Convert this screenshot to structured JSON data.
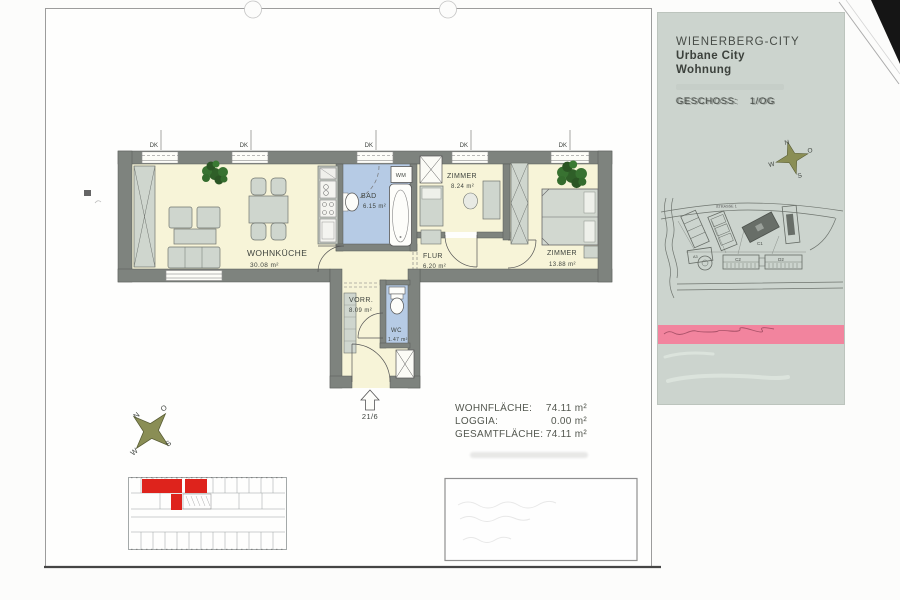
{
  "panel": {
    "title": "WIENERBERG-CITY",
    "subtitle_line1": "Urbane City",
    "subtitle_line2": "Wohnung",
    "floor_label": "GESCHOSS:",
    "floor_value": "1/OG",
    "site_plan": {
      "street_label": "STRASSE 1",
      "c1": "C1",
      "c2": "C2",
      "d2": "D2",
      "a3": "A3"
    },
    "compass": {
      "n": "N",
      "o": "O",
      "s": "S",
      "w": "W"
    }
  },
  "floor_plan": {
    "window_label": "DK",
    "entrance_number": "21/6",
    "rooms": {
      "wohnkueche": {
        "name": "WOHNKÜCHE",
        "area": "30.08 m²"
      },
      "bad": {
        "name": "BAD",
        "area": "6.15 m²"
      },
      "wm": {
        "name": "WM"
      },
      "zimmer1": {
        "name": "ZIMMER",
        "area": "8.24 m²"
      },
      "flur": {
        "name": "FLUR",
        "area": "6.20 m²"
      },
      "zimmer2": {
        "name": "ZIMMER",
        "area": "13.88 m²"
      },
      "vorraum": {
        "name": "VORR.",
        "area": "8.09 m²"
      },
      "wc": {
        "name": "WC",
        "area": "1.47 m²"
      }
    }
  },
  "area_summary": {
    "rows": [
      {
        "label": "WOHNFLÄCHE:",
        "value": "74.11 m²"
      },
      {
        "label": "LOGGIA:",
        "value": "0.00 m²"
      },
      {
        "label": "GESAMTFLÄCHE:",
        "value": "74.11 m²"
      }
    ]
  },
  "compass_main": {
    "n": "N",
    "o": "O",
    "s": "S",
    "w": "W"
  }
}
